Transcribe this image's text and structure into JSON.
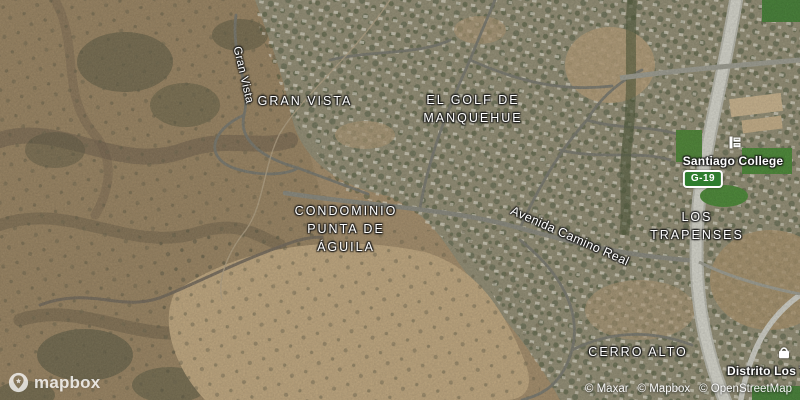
{
  "map": {
    "provider": "Mapbox satellite",
    "labels": {
      "gran_vista": {
        "text": "GRAN VISTA"
      },
      "el_golf": {
        "lines": [
          "EL GOLF DE",
          "MANQUEHUE"
        ]
      },
      "condominio_punta_de_aguila": {
        "lines": [
          "CONDOMINIO",
          "PUNTA DE",
          "ÁGUILA"
        ]
      },
      "los_trapenses": {
        "lines": [
          "LOS",
          "TRAPENSES"
        ]
      },
      "cerro_alto": {
        "text": "CERRO ALTO"
      },
      "santiago_college": {
        "text": "Santiago College"
      },
      "distrito_los_trapenses": {
        "text": "Distrito Los Tra"
      },
      "gran_vista_street": {
        "text": "Gran Vista"
      },
      "avenida_camino_real_street": {
        "text": "Avenida Camino Real"
      },
      "route_shield": {
        "text": "G-19"
      }
    },
    "icons": {
      "santiago_college": "school-icon",
      "distrito_los_trapenses": "shopping-bag-icon",
      "logo": "mapbox-pin-icon"
    },
    "colors": {
      "route_shield_bg": "#2e7d2e",
      "route_shield_border": "#ffffff",
      "label_color": "#ffffff",
      "terrain_tan": "#a28a66",
      "suburb_gray_green": "#8f8a70",
      "dirt_light": "#c0a67c",
      "field_green": "#44852f",
      "highway_gray": "#d6d6cc"
    },
    "logo": {
      "wordmark": "mapbox"
    },
    "attribution": {
      "items": [
        "© Maxar",
        "© Mapbox",
        "© OpenStreetMap"
      ]
    }
  }
}
